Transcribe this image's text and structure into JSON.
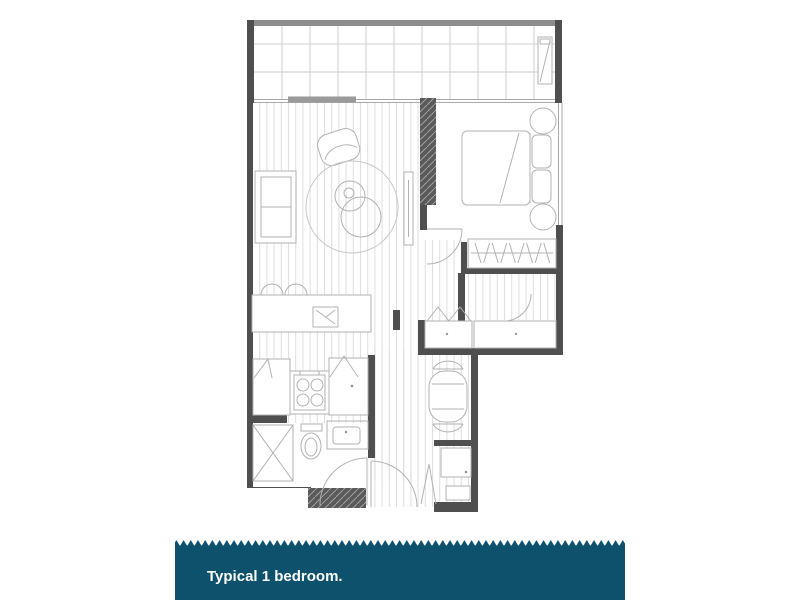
{
  "banner": {
    "label": "Typical 1 bedroom.",
    "background": "#0d516d",
    "text_color": "#ffffff"
  },
  "plan": {
    "type": "architectural-floor-plan",
    "rooms": [
      "balcony",
      "living-dining",
      "kitchen",
      "bedroom",
      "wardrobe",
      "bathroom",
      "laundry",
      "entry-hall"
    ],
    "furniture": [
      "sofa",
      "armchair",
      "round-rug",
      "coffee-tables",
      "tv-unit",
      "kitchen-island",
      "sink",
      "bar-stools",
      "cooktop",
      "fridge-cabinet",
      "pantry-cabinet",
      "double-bed",
      "pillows",
      "bedside-tables",
      "hanging-rail",
      "linen-closets",
      "dining-table",
      "dining-chairs",
      "shower",
      "toilet",
      "vanity-basin",
      "washing-machine",
      "laundry-tub",
      "balcony-planter"
    ],
    "colors": {
      "wall": "#4f4f4f",
      "furniture_line": "#b2b2b2",
      "floorboard_line": "#dedede",
      "background": "#ffffff"
    }
  }
}
